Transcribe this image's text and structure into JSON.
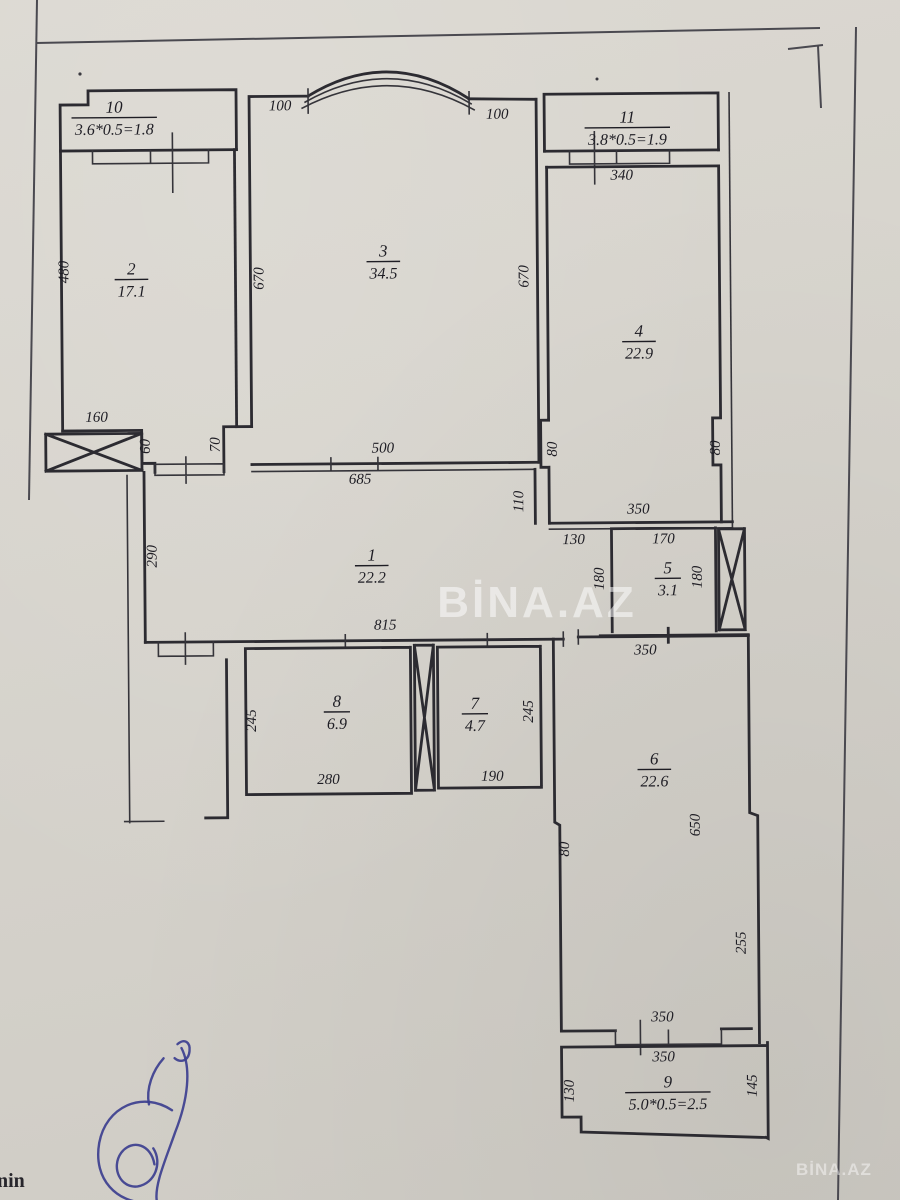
{
  "document": {
    "kind": "apartment floor plan scan",
    "watermark_center": "BİNA.AZ",
    "watermark_corner": "BİNA.AZ",
    "edge_fragment": "nin",
    "colors": {
      "paper": "#d7d4cd",
      "ink": "#2c2b31",
      "signature": "#3c3f8f",
      "watermark": "rgba(255,255,255,0.5)"
    }
  },
  "rooms": [
    {
      "id": "10",
      "area": "3.6*0.5=1.8",
      "x": 118,
      "y": 110
    },
    {
      "id": "2",
      "area": "17.1",
      "x": 134,
      "y": 272
    },
    {
      "id": "3",
      "area": "34.5",
      "x": 386,
      "y": 256
    },
    {
      "id": "11",
      "area": "3.8*0.5=1.9",
      "x": 631,
      "y": 124
    },
    {
      "id": "4",
      "area": "22.9",
      "x": 641,
      "y": 338
    },
    {
      "id": "1",
      "area": "22.2",
      "x": 372,
      "y": 560
    },
    {
      "id": "5",
      "area": "3.1",
      "x": 668,
      "y": 575
    },
    {
      "id": "8",
      "area": "6.9",
      "x": 336,
      "y": 706
    },
    {
      "id": "7",
      "area": "4.7",
      "x": 474,
      "y": 709
    },
    {
      "id": "6",
      "area": "22.6",
      "x": 653,
      "y": 766
    },
    {
      "id": "9",
      "area": "5.0*0.5=2.5",
      "x": 664,
      "y": 1089
    }
  ],
  "dimensions": [
    {
      "t": "100",
      "x": 284,
      "y": 109,
      "rot": 0
    },
    {
      "t": "100",
      "x": 501,
      "y": 119,
      "rot": 0
    },
    {
      "t": "480",
      "x": 71,
      "y": 269,
      "rot": -90
    },
    {
      "t": "670",
      "x": 266,
      "y": 277,
      "rot": -90
    },
    {
      "t": "670",
      "x": 531,
      "y": 277,
      "rot": -90
    },
    {
      "t": "340",
      "x": 625,
      "y": 181,
      "rot": 0
    },
    {
      "t": "160",
      "x": 98,
      "y": 419,
      "rot": 0
    },
    {
      "t": "60",
      "x": 151,
      "y": 444,
      "rot": -90
    },
    {
      "t": "70",
      "x": 221,
      "y": 443,
      "rot": -90
    },
    {
      "t": "500",
      "x": 384,
      "y": 452,
      "rot": 0
    },
    {
      "t": "685",
      "x": 361,
      "y": 483,
      "rot": 0
    },
    {
      "t": "110",
      "x": 524,
      "y": 502,
      "rot": -90
    },
    {
      "t": "80",
      "x": 558,
      "y": 450,
      "rot": -90
    },
    {
      "t": "80",
      "x": 721,
      "y": 450,
      "rot": -90
    },
    {
      "t": "350",
      "x": 639,
      "y": 515,
      "rot": 0
    },
    {
      "t": "130",
      "x": 574,
      "y": 545,
      "rot": 0
    },
    {
      "t": "170",
      "x": 664,
      "y": 545,
      "rot": 0
    },
    {
      "t": "180",
      "x": 604,
      "y": 580,
      "rot": -90
    },
    {
      "t": "180",
      "x": 702,
      "y": 579,
      "rot": -90
    },
    {
      "t": "290",
      "x": 157,
      "y": 554,
      "rot": -90
    },
    {
      "t": "815",
      "x": 385,
      "y": 629,
      "rot": 0
    },
    {
      "t": "350",
      "x": 645,
      "y": 656,
      "rot": 0
    },
    {
      "t": "245",
      "x": 255,
      "y": 719,
      "rot": -90
    },
    {
      "t": "280",
      "x": 327,
      "y": 783,
      "rot": 0
    },
    {
      "t": "245",
      "x": 532,
      "y": 712,
      "rot": -90
    },
    {
      "t": "190",
      "x": 491,
      "y": 781,
      "rot": 0
    },
    {
      "t": "650",
      "x": 698,
      "y": 827,
      "rot": -90
    },
    {
      "t": "80",
      "x": 567,
      "y": 850,
      "rot": -90
    },
    {
      "t": "255",
      "x": 743,
      "y": 945,
      "rot": -90
    },
    {
      "t": "350",
      "x": 659,
      "y": 1023,
      "rot": 0
    },
    {
      "t": "350",
      "x": 660,
      "y": 1063,
      "rot": 0
    },
    {
      "t": "130",
      "x": 570,
      "y": 1092,
      "rot": -90
    },
    {
      "t": "145",
      "x": 753,
      "y": 1088,
      "rot": -90
    }
  ]
}
